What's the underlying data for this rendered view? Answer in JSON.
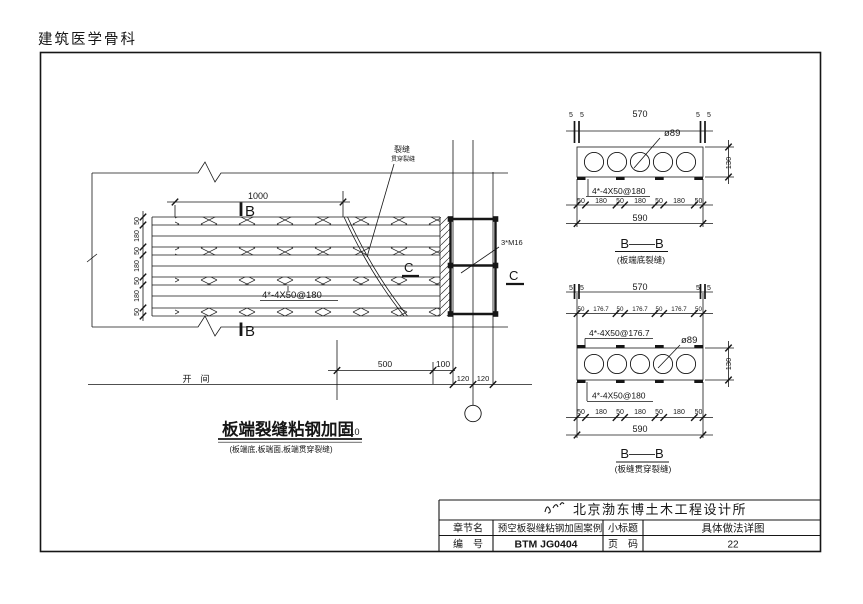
{
  "page": {
    "header_title": "建筑医学骨科"
  },
  "plan": {
    "dim_1000": "1000",
    "section_marker_b": "B",
    "crack_callout": {
      "line1": "裂缝",
      "line2": "贯穿裂缝"
    },
    "plate_label": "4*-4X50@180",
    "bolt_label": "3*M16",
    "section_marker_c": "C",
    "left_dims": [
      "50",
      "180",
      "50",
      "180",
      "50",
      "180",
      "50"
    ],
    "dim_500": "500",
    "dim_100": "100",
    "dims_120": [
      "120",
      "120"
    ],
    "bay_label": "开　间",
    "title": "板端裂缝粘钢加固",
    "title_scale": "1:10",
    "title_note": "(板端底,板端面,板端贯穿裂缝)"
  },
  "section_top": {
    "dim_5": "5",
    "dim_570": "570",
    "dia_label": "ø89",
    "dim_130": "130",
    "plate_label": "4*-4X50@180",
    "chain": [
      "50",
      "180",
      "50",
      "180",
      "50",
      "180",
      "50"
    ],
    "dim_590": "590",
    "name": "B——B",
    "note": "(板端底裂缝)"
  },
  "section_bottom": {
    "dim_5": "5",
    "dim_570": "570",
    "top_chain": [
      "50",
      "176.7",
      "50",
      "176.7",
      "50",
      "176.7",
      "50"
    ],
    "plate_label_top": "4*-4X50@176.7",
    "dia_label": "ø89",
    "plate_label_bottom": "4*-4X50@180",
    "bottom_chain": [
      "50",
      "180",
      "50",
      "180",
      "50",
      "180",
      "50"
    ],
    "dim_590": "590",
    "dim_130": "130",
    "name": "B——B",
    "note": "(板缝贯穿裂缝)"
  },
  "title_block": {
    "company": "北京渤东博土木工程设计所",
    "row_chapter": {
      "label": "章节名",
      "value": "预空板裂缝粘钢加固案例",
      "label2": "小标题",
      "value2": "具体做法详图"
    },
    "row_number": {
      "label": "编　号",
      "value": "BTM JG0404",
      "label2": "页　码",
      "value2": "22"
    }
  }
}
